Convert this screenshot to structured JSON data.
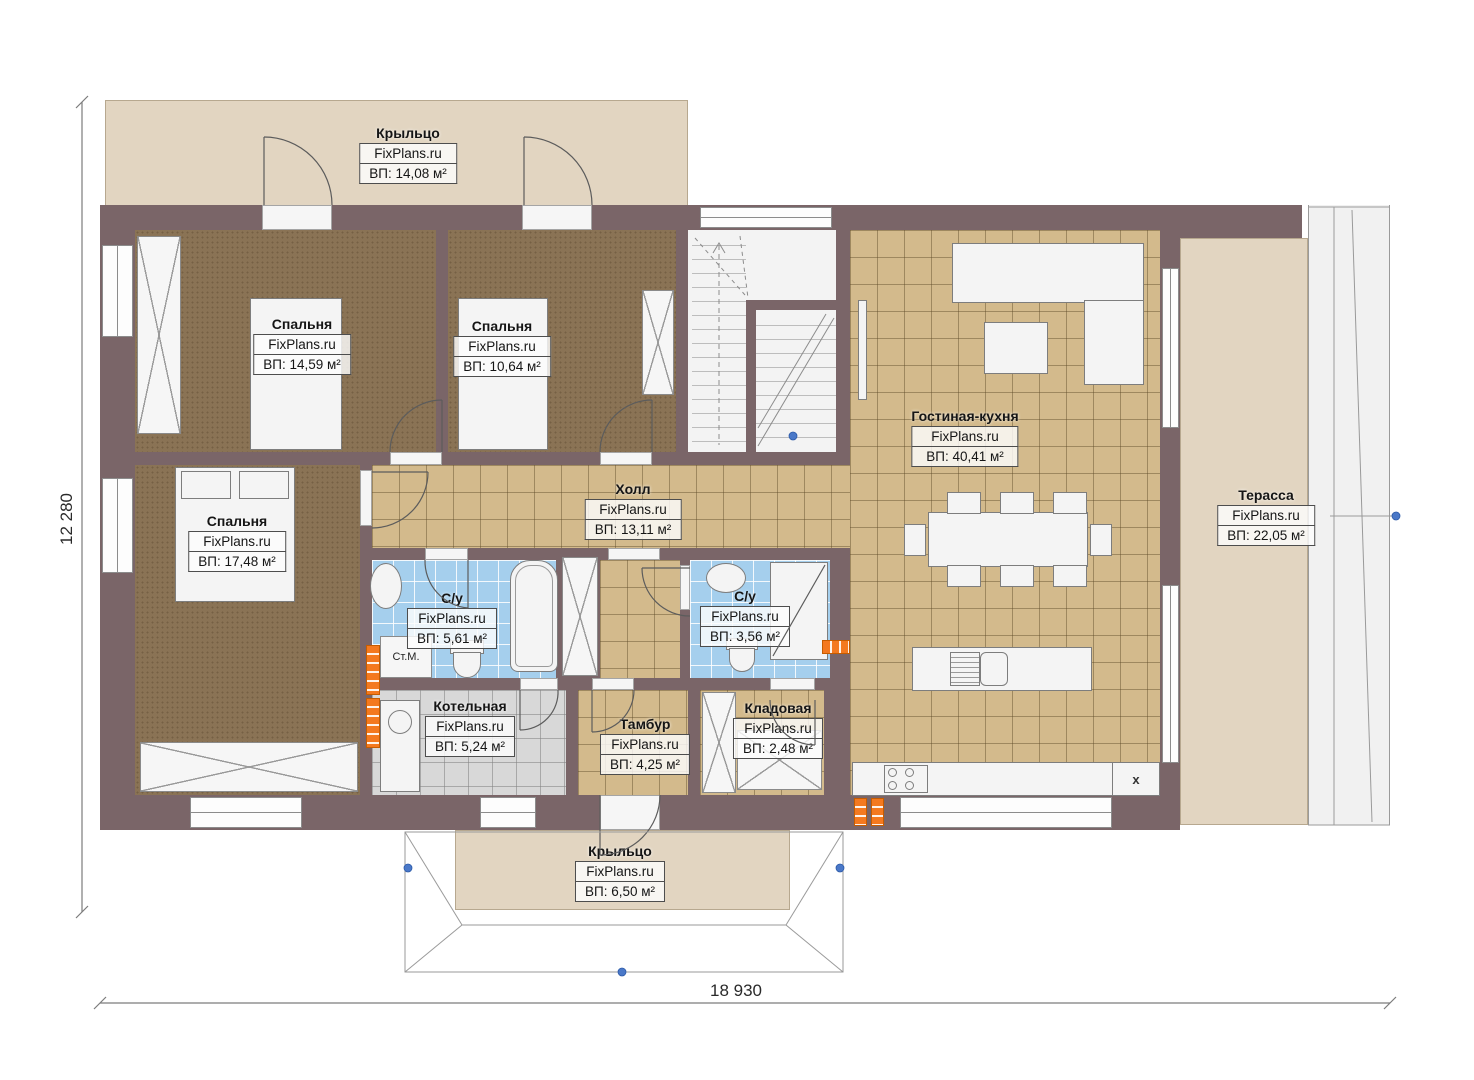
{
  "plan": {
    "brand": "FixPlans.ru",
    "rooms": [
      {
        "id": "porch-top",
        "name": "Крыльцо",
        "area": "ВП: 14,08 м²"
      },
      {
        "id": "bedroom-1",
        "name": "Спальня",
        "area": "ВП: 14,59 м²"
      },
      {
        "id": "bedroom-2",
        "name": "Спальня",
        "area": "ВП: 10,64 м²"
      },
      {
        "id": "bedroom-3",
        "name": "Спальня",
        "area": "ВП: 17,48 м²"
      },
      {
        "id": "hall",
        "name": "Холл",
        "area": "ВП: 13,11 м²"
      },
      {
        "id": "living-kitchen",
        "name": "Гостиная-кухня",
        "area": "ВП: 40,41 м²"
      },
      {
        "id": "terrace",
        "name": "Терасса",
        "area": "ВП: 22,05 м²"
      },
      {
        "id": "bathroom-1",
        "name": "С/у",
        "area": "ВП: 5,61 м²"
      },
      {
        "id": "bathroom-2",
        "name": "С/у",
        "area": "ВП: 3,56 м²"
      },
      {
        "id": "boiler-room",
        "name": "Котельная",
        "area": "ВП: 5,24 м²"
      },
      {
        "id": "vestibule",
        "name": "Тамбур",
        "area": "ВП: 4,25 м²"
      },
      {
        "id": "storage",
        "name": "Кладовая",
        "area": "ВП: 2,48 м²"
      },
      {
        "id": "porch-bottom",
        "name": "Крыльцо",
        "area": "ВП: 6,50 м²"
      }
    ],
    "annotations": {
      "washing_machine": "Ст.М.",
      "fridge_marker": "x"
    },
    "dimensions": {
      "overall_width": "18 930",
      "overall_height": "12 280"
    },
    "colors": {
      "wall": "#7a6568",
      "carpet": "#8a7355",
      "tile_tan": "#d3ba8c",
      "tile_blue": "#a5cfed",
      "tile_gray": "#d8d8d8",
      "porch": "#e2d5c1",
      "radiator": "#f4791f"
    }
  }
}
